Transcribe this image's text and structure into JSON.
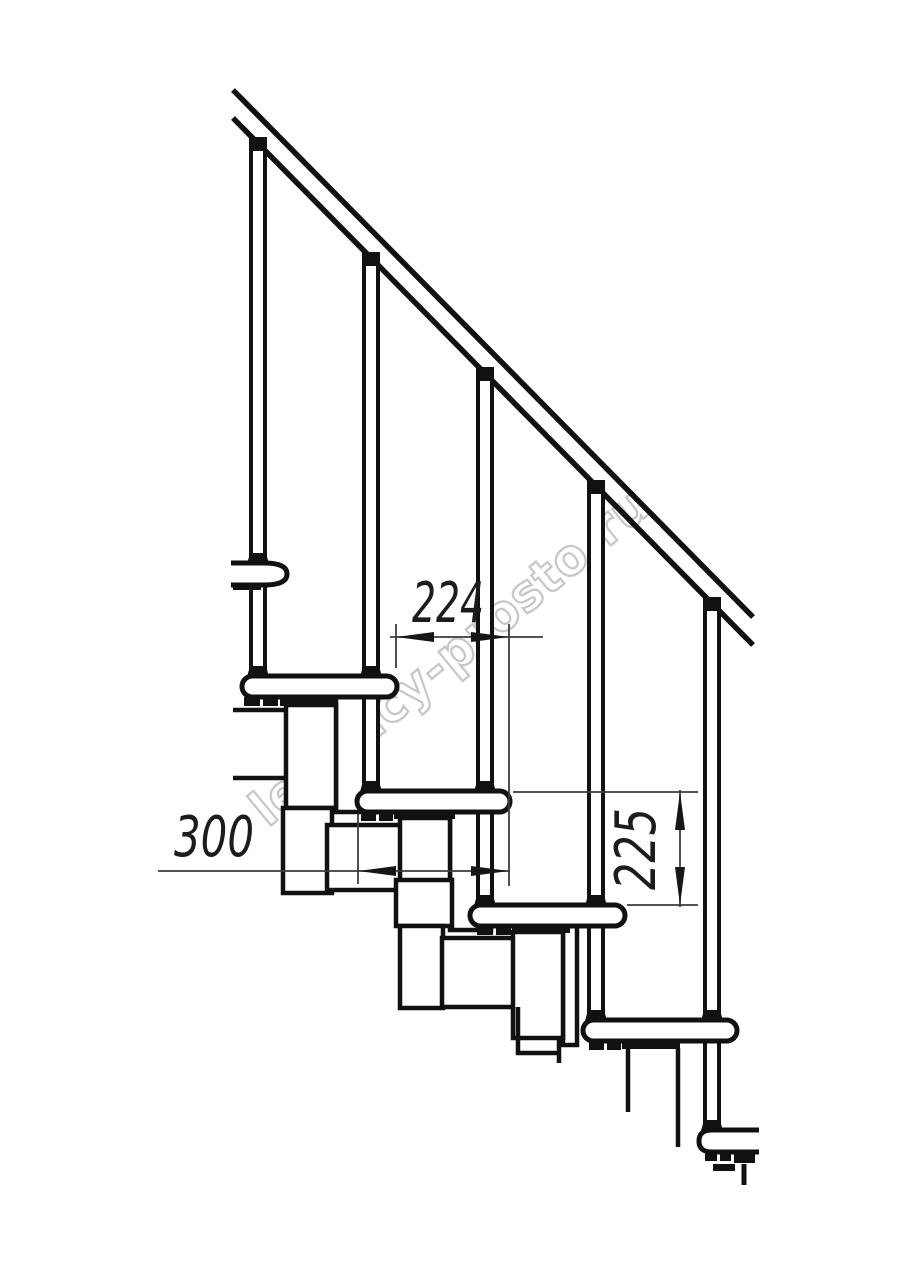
{
  "page": {
    "width": 914,
    "height": 1280,
    "background_color": "#ffffff"
  },
  "drawing": {
    "kind": "technical line drawing",
    "subject": "modular staircase side section with handrail, balusters, treads and step modules",
    "ink_color": "#111111",
    "dimension_line_color": "#3c3c3c",
    "counts": {
      "balusters": 5,
      "treads": 4,
      "wall_brackets": 2
    },
    "dimensions": [
      {
        "id": "dim-224",
        "value": "224",
        "orientation": "horizontal"
      },
      {
        "id": "dim-300",
        "value": "300",
        "orientation": "horizontal"
      },
      {
        "id": "dim-225",
        "value": "225",
        "orientation": "vertical"
      }
    ],
    "watermark": {
      "text": "lestnicy-prosto.ru",
      "color": "#c7c7c7",
      "angle_deg": -39.5
    }
  }
}
